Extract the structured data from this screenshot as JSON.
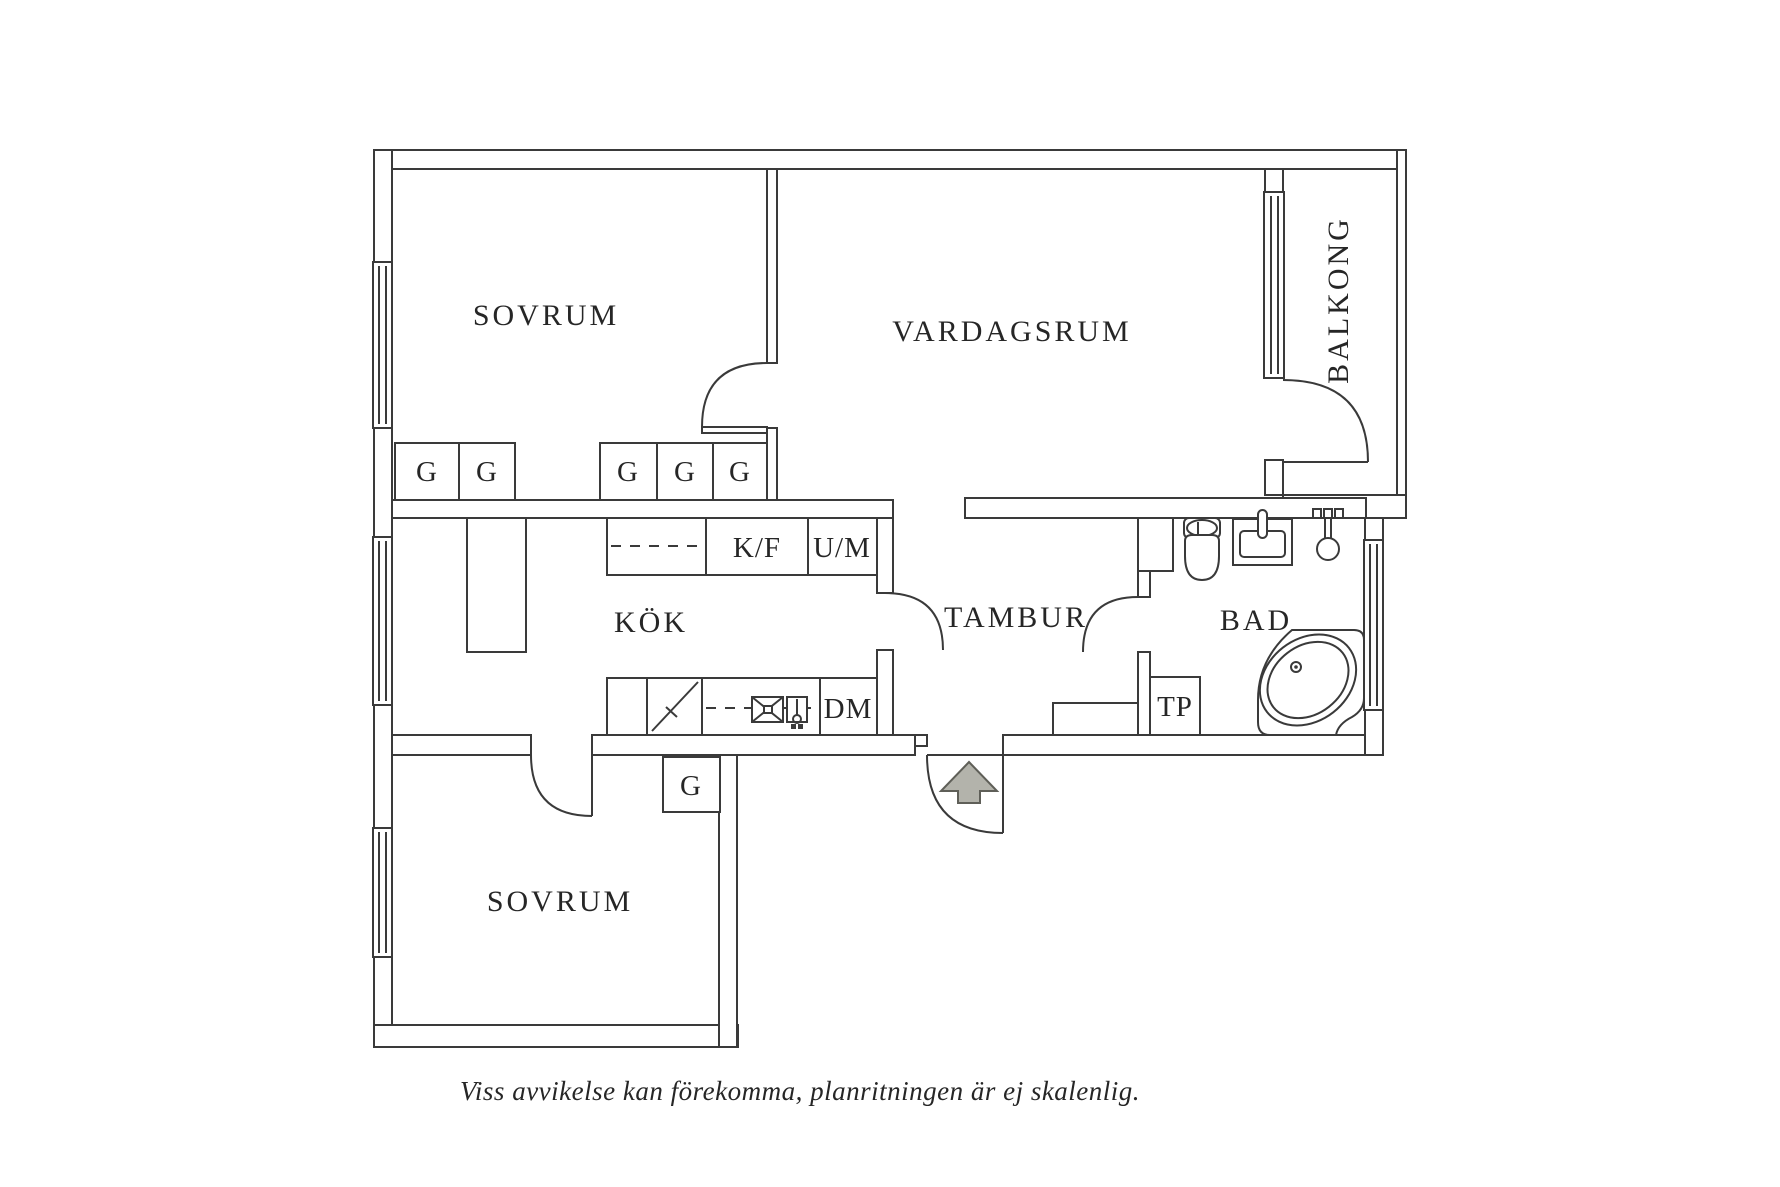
{
  "plan": {
    "caption": "Viss avvikelse kan förekomma, planritningen är ej skalenlig.",
    "line_color": "#3a3a3a",
    "text_color": "#262626",
    "arrow_fill": "#b3b3ab",
    "arrow_stroke": "#5f5f58",
    "rooms": {
      "bedroom_top": "SOVRUM",
      "living_room": "VARDAGSRUM",
      "balcony": "BALKONG",
      "kitchen": "KÖK",
      "hall": "TAMBUR",
      "bathroom": "BAD",
      "bedroom_bottom": "SOVRUM"
    },
    "markers": {
      "wardrobe": "G",
      "fridge_freezer": "K/F",
      "washing_machine": "U/M",
      "dishwasher": "DM",
      "towel_dryer": "TP"
    }
  }
}
